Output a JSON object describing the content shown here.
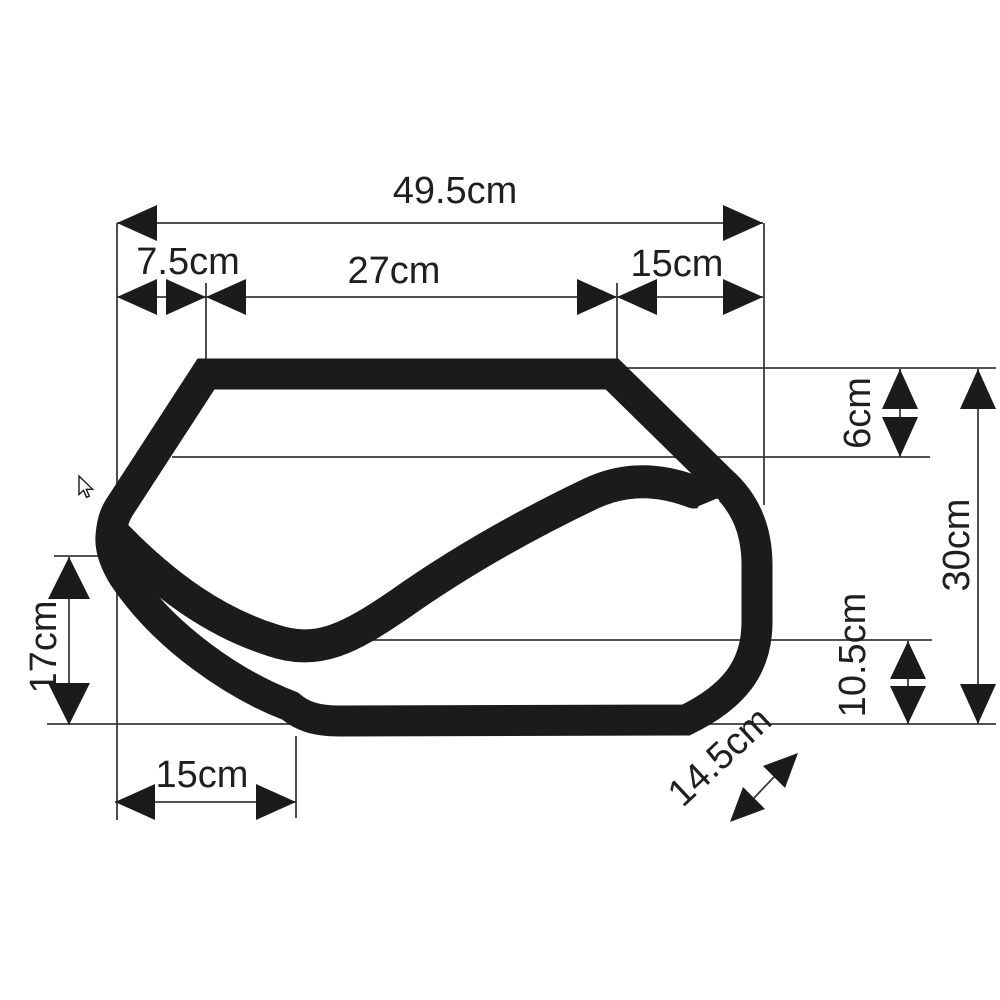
{
  "diagram": {
    "dimensions": {
      "overall_width": "49.5cm",
      "top_segment_left": "7.5cm",
      "top_segment_middle": "27cm",
      "top_segment_right": "15cm",
      "right_top_height": "6cm",
      "right_total_height": "30cm",
      "right_bottom_height": "10.5cm",
      "left_height": "17cm",
      "bottom_width": "15cm",
      "bottom_diagonal": "14.5cm"
    }
  },
  "colors": {
    "ink": "#1b1b1b",
    "dim_line": "#3a3a3a",
    "label_text": "#1f1f1f",
    "background": "#ffffff"
  },
  "cursor": {
    "icon": "arrow-pointer"
  }
}
